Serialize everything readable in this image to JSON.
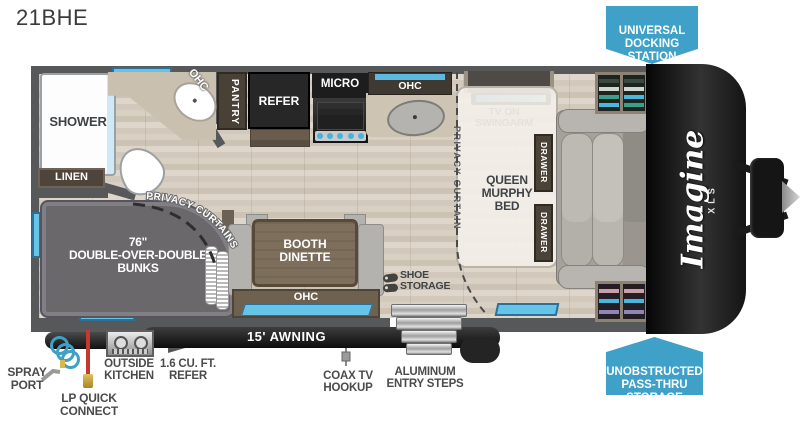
{
  "title": "21BHE",
  "colors": {
    "badge_blue": "#3FA0C8",
    "window_blue": "#66C4E8",
    "wall_gray": "#57585A",
    "floor_tan": "#D6CCC0",
    "bunk_gray": "#6B686C",
    "cap_black": "#161616"
  },
  "badges": {
    "universal_docking": "UNIVERSAL\nDOCKING\nSTATION",
    "pass_thru": "UNOBSTRUCTED\nPASS-THRU\nSTORAGE"
  },
  "brand": {
    "name": "Imagine",
    "series": "XLS"
  },
  "interior": {
    "shower": "SHOWER",
    "linen": "LINEN",
    "bath_ohc": "OHC",
    "pantry": "PANTRY",
    "refer": "REFER",
    "micro": "MICRO",
    "kitchen_ohc": "OHC",
    "tv": "TV ON\nSWINGARM",
    "murphy_bed": "QUEEN\nMURPHY\nBED",
    "drawer_top": "DRAWER",
    "drawer_bottom": "DRAWER",
    "privacy_curtain": "PRIVACY CURTAIN",
    "privacy_curtains": "PRIVACY CURTAINS",
    "bunks": "76\"\nDOUBLE-OVER-DOUBLE\nBUNKS",
    "dinette": "BOOTH\nDINETTE",
    "dinette_ohc": "OHC",
    "shoe_storage": "SHOE\nSTORAGE"
  },
  "exterior": {
    "awning": "15' AWNING",
    "spray_port": "SPRAY\nPORT",
    "lp_quick_connect": "LP QUICK\nCONNECT",
    "outside_kitchen": "OUTSIDE\nKITCHEN",
    "outside_refer": "1.6 CU. FT.\nREFER",
    "coax": "COAX TV\nHOOKUP",
    "entry_steps": "ALUMINUM\nENTRY STEPS"
  }
}
